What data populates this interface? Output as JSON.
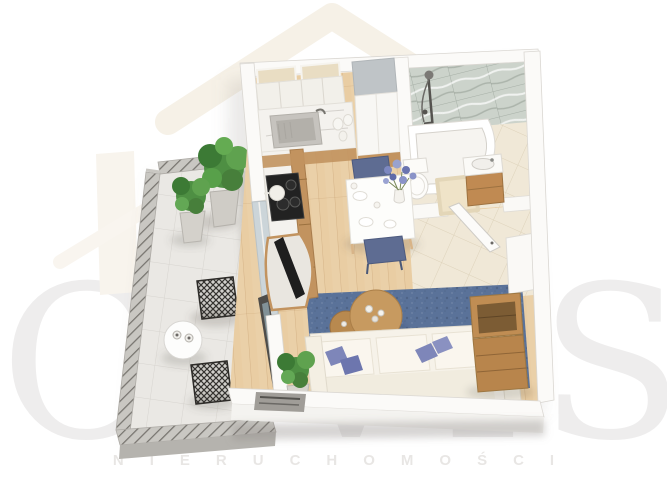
{
  "watermark": {
    "brand": "CIVIS",
    "subtitle": "NIERUCHOMOŚCI",
    "logo": "house-roof-icon"
  },
  "palette": {
    "background": "#ffffff",
    "wall": "#fbfaf8",
    "wall_shade": "#f4f3f0",
    "wood_floor": "#e9cda3",
    "bathroom_tile": "#f0e8d7",
    "balcony_tile": "#eae8e4",
    "marble_wall": "#ccd3cb",
    "rug": "#5a7299",
    "sofa": "#f6f2e9",
    "sofa_cushion": "#faf6ee",
    "pillow": "#7e86b9",
    "pillow_dark": "#6d76ae",
    "kitchen_wood": "#c2935f",
    "furniture_wood": "#c08d53",
    "counter_marble": "#f4f2ee",
    "cooktop": "#222222",
    "sink": "#b3b0aa",
    "dining_chair": "#5e6c92",
    "dining_table": "#fdfdfb",
    "plant": "#4e8f43",
    "railing": "#c9c7c2",
    "bathtub": "#ffffff",
    "glass": "#ccd5d9",
    "coffee_table": "#c79a60",
    "tv": "#1e1e1e",
    "door": "#fcfbf9",
    "vanity_wood": "#c08a52",
    "bath_mat": "#efe3c8",
    "balcony_table": "#fdfdfc"
  }
}
